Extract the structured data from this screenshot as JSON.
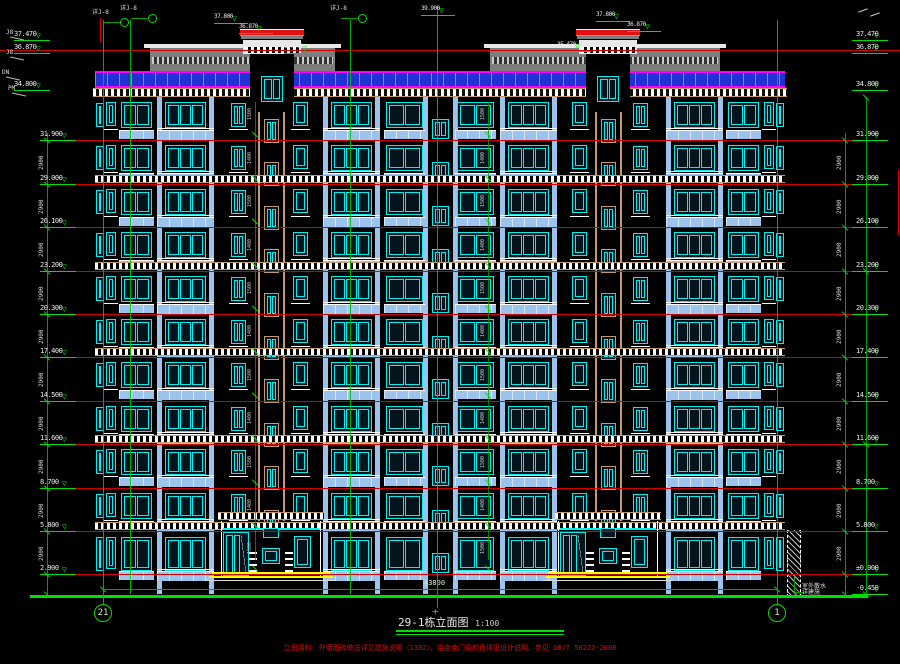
{
  "title_block": {
    "title": "29-1栋立面图",
    "scale": "1:100",
    "note": "立面用料：外墙面砖做法详见建施说明（1302），铝合金门窗颜色详见设计说明，参见 GB/T 50222-2008"
  },
  "colors": {
    "cyan": "#00f0f0",
    "glass": "#03141d",
    "sky": "#9cc3ec",
    "panel_blue": "#2230d8",
    "magenta": "#ff00ff",
    "tan": "#c49a6c",
    "gray": "#7d7d7d",
    "gray_dark": "#4a4a4a",
    "white": "#ffffff",
    "red": "#e01010",
    "red_line": "#d40000",
    "green": "#00e000",
    "green_dim": "#00a000",
    "yellow": "#ffff00",
    "text": "#e8e8e8"
  },
  "building": {
    "x": 95,
    "w": 690,
    "top": 97,
    "ground_y": 594,
    "rows": [
      97,
      140,
      184,
      227,
      271,
      314,
      357,
      401,
      444,
      488,
      531
    ],
    "floor_lines": [
      140,
      184,
      227,
      271,
      314,
      357,
      401,
      444,
      488,
      531,
      574
    ],
    "band_lines": [
      184,
      271,
      357,
      444,
      531
    ],
    "bays": [
      {
        "x": 96,
        "w": 8,
        "t": "slit"
      },
      {
        "x": 106,
        "w": 10,
        "t": "narrow"
      },
      {
        "x": 121,
        "w": 31,
        "t": "double"
      },
      {
        "x": 157,
        "w": 57,
        "t": "balcony3"
      },
      {
        "x": 231,
        "w": 15,
        "t": "small"
      },
      {
        "x": 258,
        "w": 27,
        "t": "stair"
      },
      {
        "x": 293,
        "w": 15,
        "t": "narrow"
      },
      {
        "x": 323,
        "w": 57,
        "t": "balcony3"
      },
      {
        "x": 386,
        "w": 37,
        "t": "double"
      },
      {
        "x": 429,
        "w": 23,
        "t": "center"
      },
      {
        "x": 457,
        "w": 37,
        "t": "double"
      },
      {
        "x": 500,
        "w": 57,
        "t": "balcony3"
      },
      {
        "x": 572,
        "w": 15,
        "t": "narrow"
      },
      {
        "x": 595,
        "w": 27,
        "t": "stair"
      },
      {
        "x": 633,
        "w": 15,
        "t": "small"
      },
      {
        "x": 666,
        "w": 57,
        "t": "balcony3"
      },
      {
        "x": 728,
        "w": 31,
        "t": "double"
      },
      {
        "x": 764,
        "w": 10,
        "t": "narrow"
      },
      {
        "x": 776,
        "w": 8,
        "t": "slit"
      }
    ]
  },
  "roof": {
    "railing": {
      "y": 71,
      "h": 17
    },
    "cornice": {
      "y": 88,
      "h": 9
    },
    "structures": [
      {
        "x": 150,
        "w": 185
      },
      {
        "x": 490,
        "w": 230
      }
    ],
    "towers": [
      {
        "x": 250,
        "w": 44
      },
      {
        "x": 586,
        "w": 44
      }
    ]
  },
  "entrances": [
    {
      "x": 215,
      "w": 112
    },
    {
      "x": 552,
      "w": 112
    }
  ],
  "grid": {
    "bubbles": [
      {
        "label": "21",
        "x": 103
      },
      {
        "label": "1",
        "x": 777
      }
    ],
    "verticals": [
      {
        "x": 103,
        "y1": 20,
        "y2": 604
      },
      {
        "x": 130,
        "y1": 20,
        "y2": 594
      },
      {
        "x": 350,
        "y1": 20,
        "y2": 594
      },
      {
        "x": 437,
        "y1": 6,
        "y2": 608
      },
      {
        "x": 777,
        "y1": 20,
        "y2": 604
      }
    ]
  },
  "elevations": {
    "left": [
      [
        40,
        "37.470"
      ],
      [
        53,
        "36.870"
      ],
      [
        90,
        "34.800"
      ],
      [
        140,
        "31.900"
      ],
      [
        184,
        "29.000"
      ],
      [
        227,
        "26.100"
      ],
      [
        271,
        "23.200"
      ],
      [
        314,
        "20.300"
      ],
      [
        357,
        "17.400"
      ],
      [
        401,
        "14.500"
      ],
      [
        444,
        "11.600"
      ],
      [
        488,
        "8.700"
      ],
      [
        531,
        "5.800"
      ],
      [
        574,
        "2.900"
      ]
    ],
    "right": [
      [
        40,
        "37.470"
      ],
      [
        53,
        "36.870"
      ],
      [
        90,
        "34.800"
      ],
      [
        140,
        "31.900"
      ],
      [
        184,
        "29.000"
      ],
      [
        227,
        "26.100"
      ],
      [
        271,
        "23.200"
      ],
      [
        314,
        "20.300"
      ],
      [
        357,
        "17.400"
      ],
      [
        401,
        "14.500"
      ],
      [
        444,
        "11.600"
      ],
      [
        488,
        "8.700"
      ],
      [
        531,
        "5.800"
      ],
      [
        574,
        "±0.000"
      ],
      [
        594,
        "-0.450"
      ]
    ],
    "top": [
      [
        230,
        16,
        "37.800"
      ],
      [
        255,
        26,
        "36.870"
      ],
      [
        300,
        46,
        "35.470"
      ],
      [
        612,
        14,
        "37.800"
      ],
      [
        643,
        24,
        "36.870"
      ],
      [
        573,
        44,
        "35.470"
      ],
      [
        437,
        8,
        "39.900"
      ]
    ]
  },
  "dims": {
    "story": "2900",
    "total": "43800",
    "right_gap": "450",
    "inner": [
      "1500",
      "1400"
    ]
  },
  "annotations": {
    "ground_note_1": "室外散水",
    "ground_note_2": "详建施",
    "callouts": [
      "详J-8",
      "详J-8",
      "详J-8"
    ],
    "margin_labels": [
      {
        "x": 6,
        "y": 30,
        "t": "J8"
      },
      {
        "x": 6,
        "y": 50,
        "t": "J8"
      },
      {
        "x": 2,
        "y": 70,
        "t": "DN"
      },
      {
        "x": 8,
        "y": 86,
        "t": "PM"
      }
    ]
  }
}
